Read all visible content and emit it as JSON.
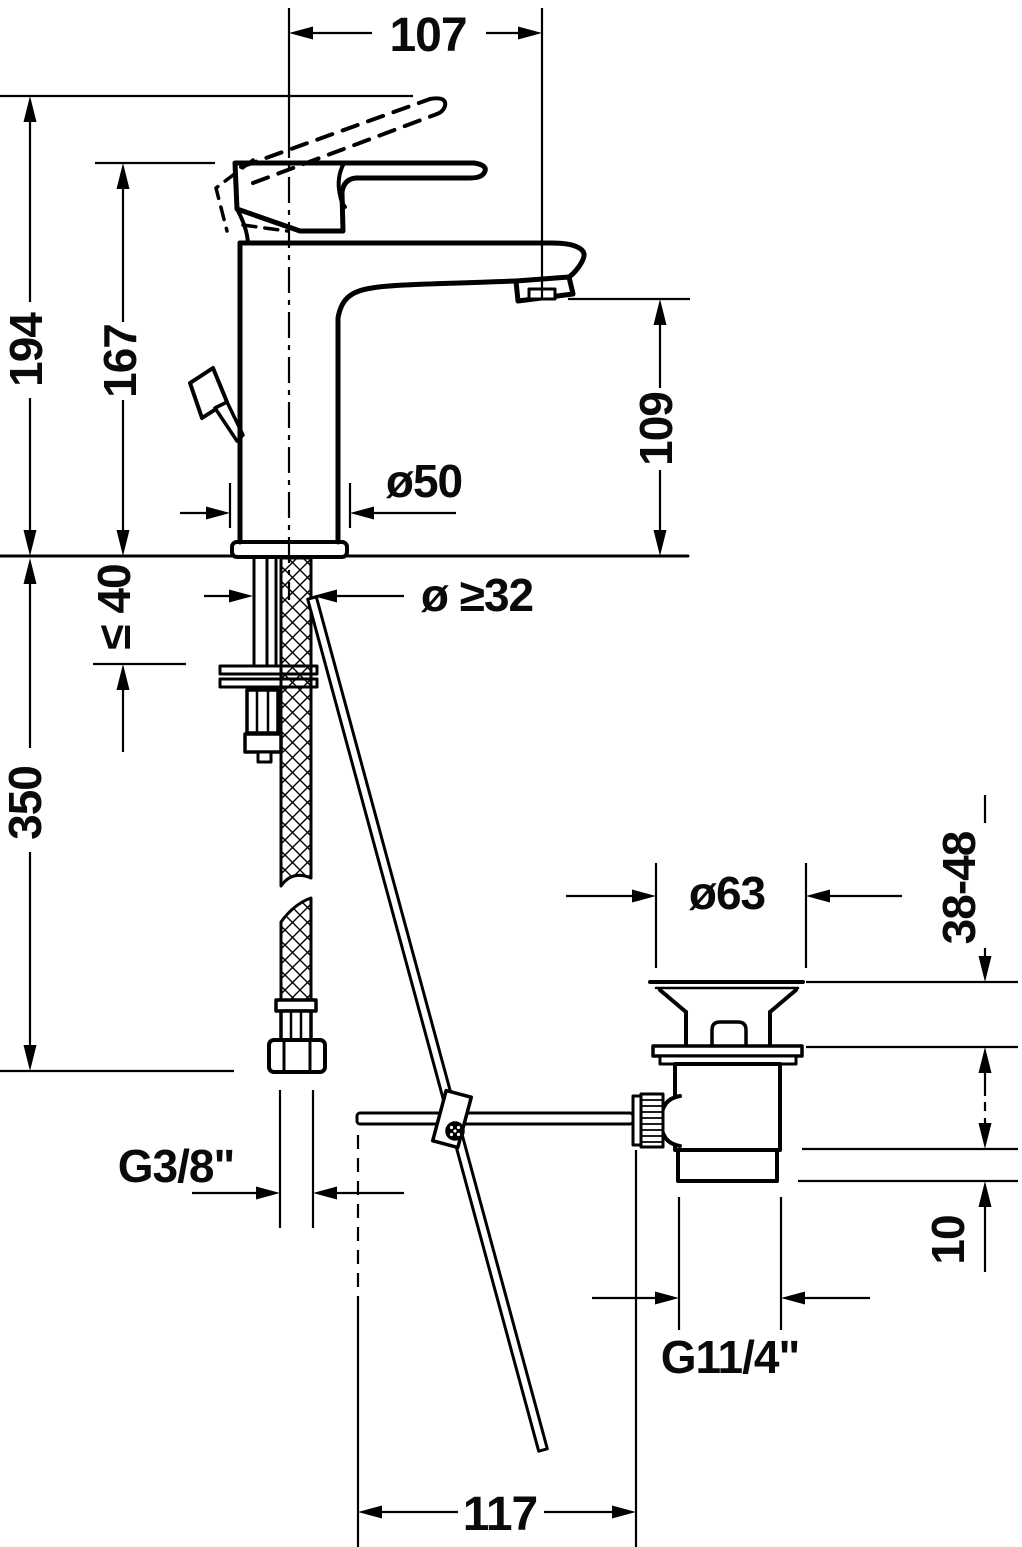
{
  "drawing": {
    "title": "Single-lever basin mixer with pop-up waste — dimension drawing",
    "type": "technical-dimension-drawing",
    "units": "mm",
    "background_color": "#ffffff",
    "line_color": "#000000",
    "dimensions": {
      "spout_reach": "107",
      "total_height": "194",
      "height_without_raised_lever": "167",
      "spout_outlet_height": "109",
      "base_diameter": "ø50",
      "mounting_hole_diameter": "ø ≥32",
      "max_mounting_thickness": "≤ 40",
      "supply_hose_length": "350",
      "supply_connection_thread": "G3/8\"",
      "waste_flange_diameter": "ø63",
      "basin_clamping_range": "38-48",
      "waste_seal_height": "10",
      "waste_thread": "G11/4\"",
      "rod_horizontal_length": "117"
    }
  }
}
